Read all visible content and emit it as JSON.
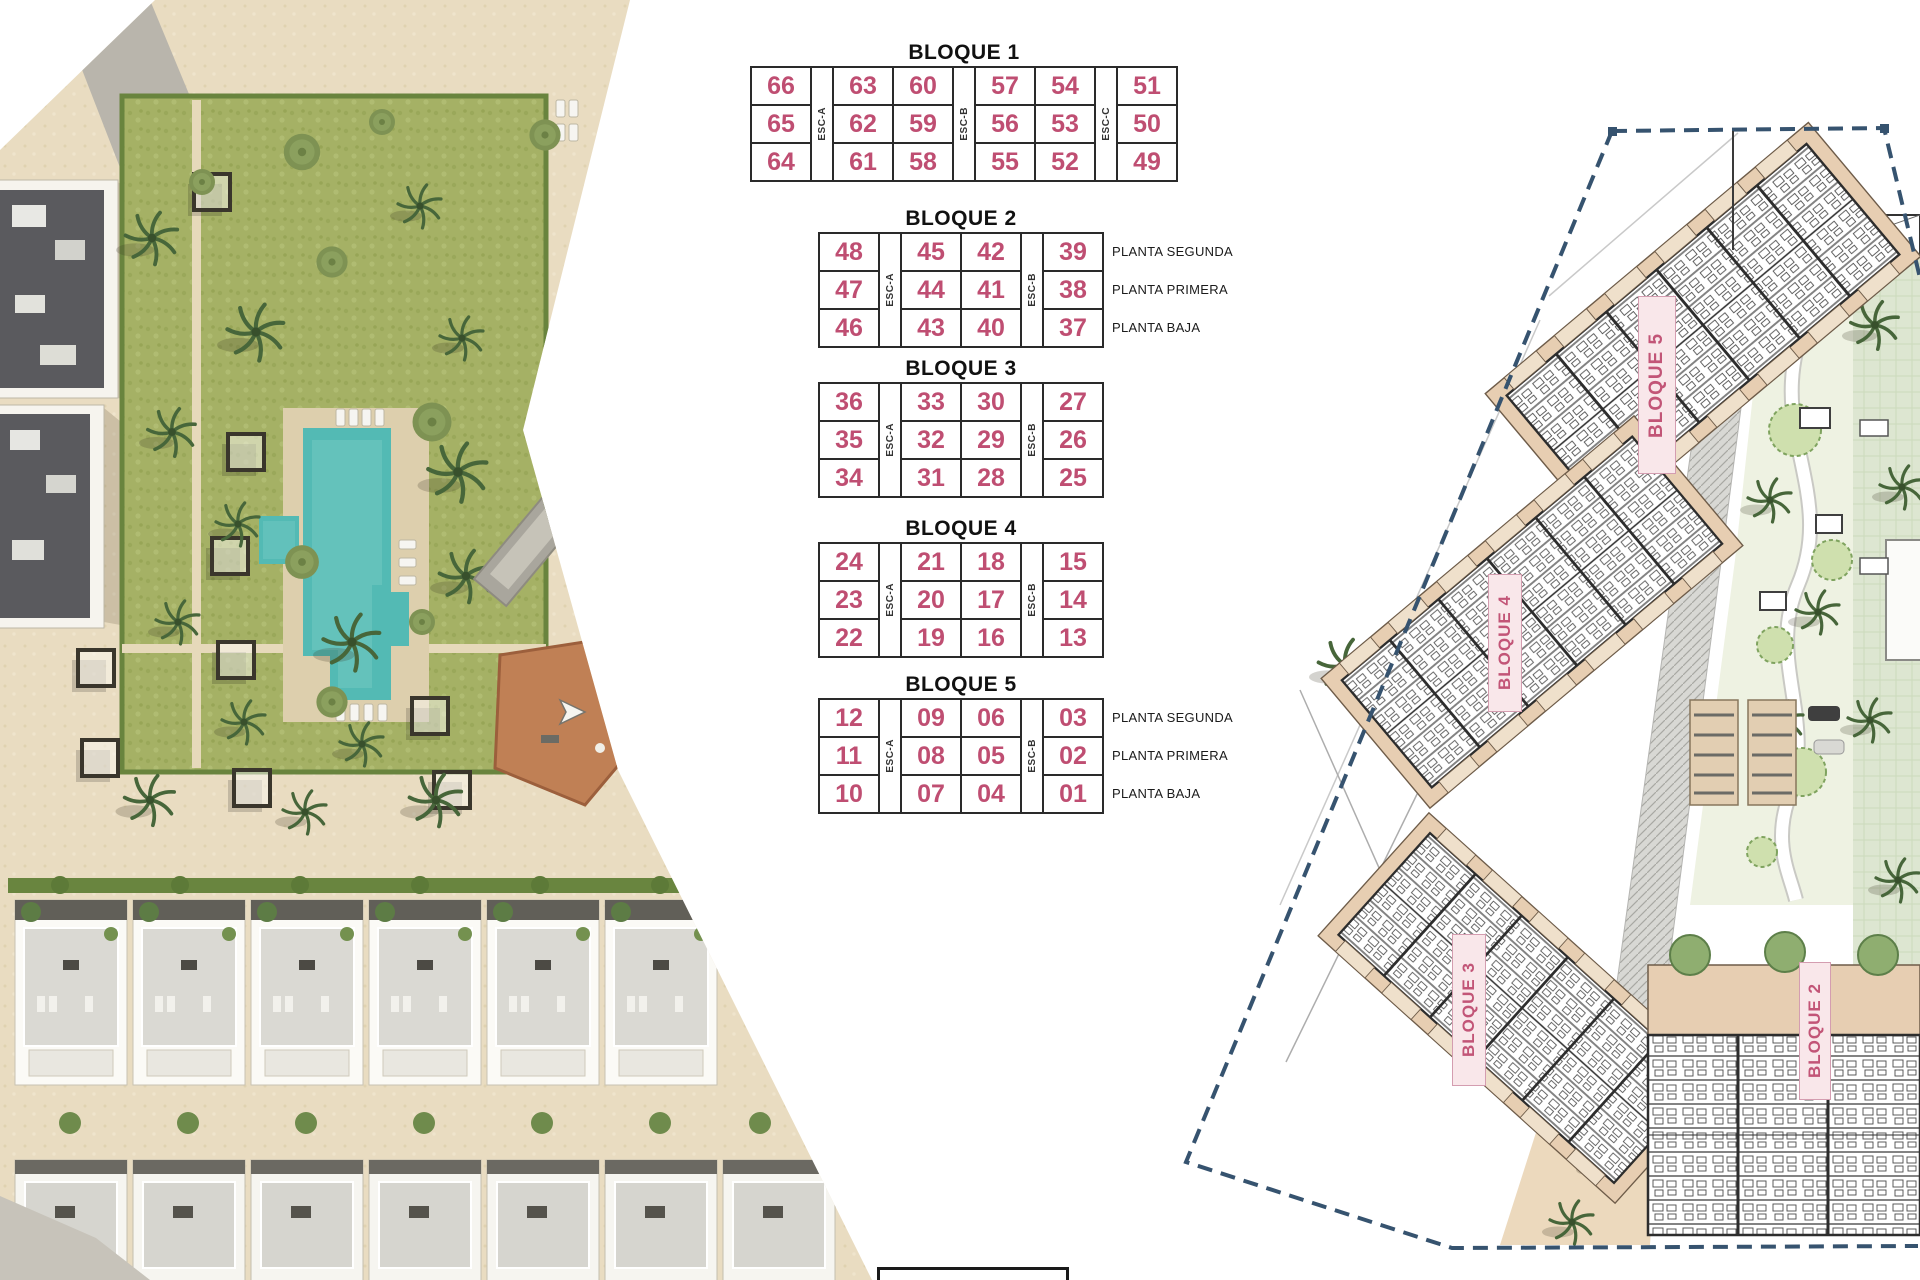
{
  "tables": {
    "bloque1": {
      "title": "BLOQUE 1",
      "esc": [
        "ESC-A",
        "ESC-B",
        "ESC-C"
      ],
      "rows": [
        [
          "66",
          "63",
          "60",
          "57",
          "54",
          "51"
        ],
        [
          "65",
          "62",
          "59",
          "56",
          "53",
          "50"
        ],
        [
          "64",
          "61",
          "58",
          "55",
          "52",
          "49"
        ]
      ]
    },
    "bloque2": {
      "title": "BLOQUE 2",
      "esc": [
        "ESC-A",
        "ESC-B"
      ],
      "rows": [
        [
          "48",
          "45",
          "42",
          "39"
        ],
        [
          "47",
          "44",
          "41",
          "38"
        ],
        [
          "46",
          "43",
          "40",
          "37"
        ]
      ],
      "floors": [
        "PLANTA SEGUNDA",
        "PLANTA PRIMERA",
        "PLANTA BAJA"
      ]
    },
    "bloque3": {
      "title": "BLOQUE 3",
      "esc": [
        "ESC-A",
        "ESC-B"
      ],
      "rows": [
        [
          "36",
          "33",
          "30",
          "27"
        ],
        [
          "35",
          "32",
          "29",
          "26"
        ],
        [
          "34",
          "31",
          "28",
          "25"
        ]
      ]
    },
    "bloque4": {
      "title": "BLOQUE 4",
      "esc": [
        "ESC-A",
        "ESC-B"
      ],
      "rows": [
        [
          "24",
          "21",
          "18",
          "15"
        ],
        [
          "23",
          "20",
          "17",
          "14"
        ],
        [
          "22",
          "19",
          "16",
          "13"
        ]
      ]
    },
    "bloque5": {
      "title": "BLOQUE 5",
      "esc": [
        "ESC-A",
        "ESC-B"
      ],
      "rows": [
        [
          "12",
          "09",
          "06",
          "03"
        ],
        [
          "11",
          "08",
          "05",
          "02"
        ],
        [
          "10",
          "07",
          "04",
          "01"
        ]
      ],
      "floors": [
        "PLANTA SEGUNDA",
        "PLANTA PRIMERA",
        "PLANTA BAJA"
      ]
    }
  },
  "plan": {
    "labels": {
      "b5": "BLOQUE 5",
      "b4": "BLOQUE 4",
      "b3": "BLOQUE 3",
      "b2": "BLOQUE 2"
    }
  },
  "colors": {
    "unit_number": "#bf4e72",
    "plan_label": "#c25577",
    "boundary_navy": "#36536f",
    "pool_turquoise": "#53bab4"
  }
}
